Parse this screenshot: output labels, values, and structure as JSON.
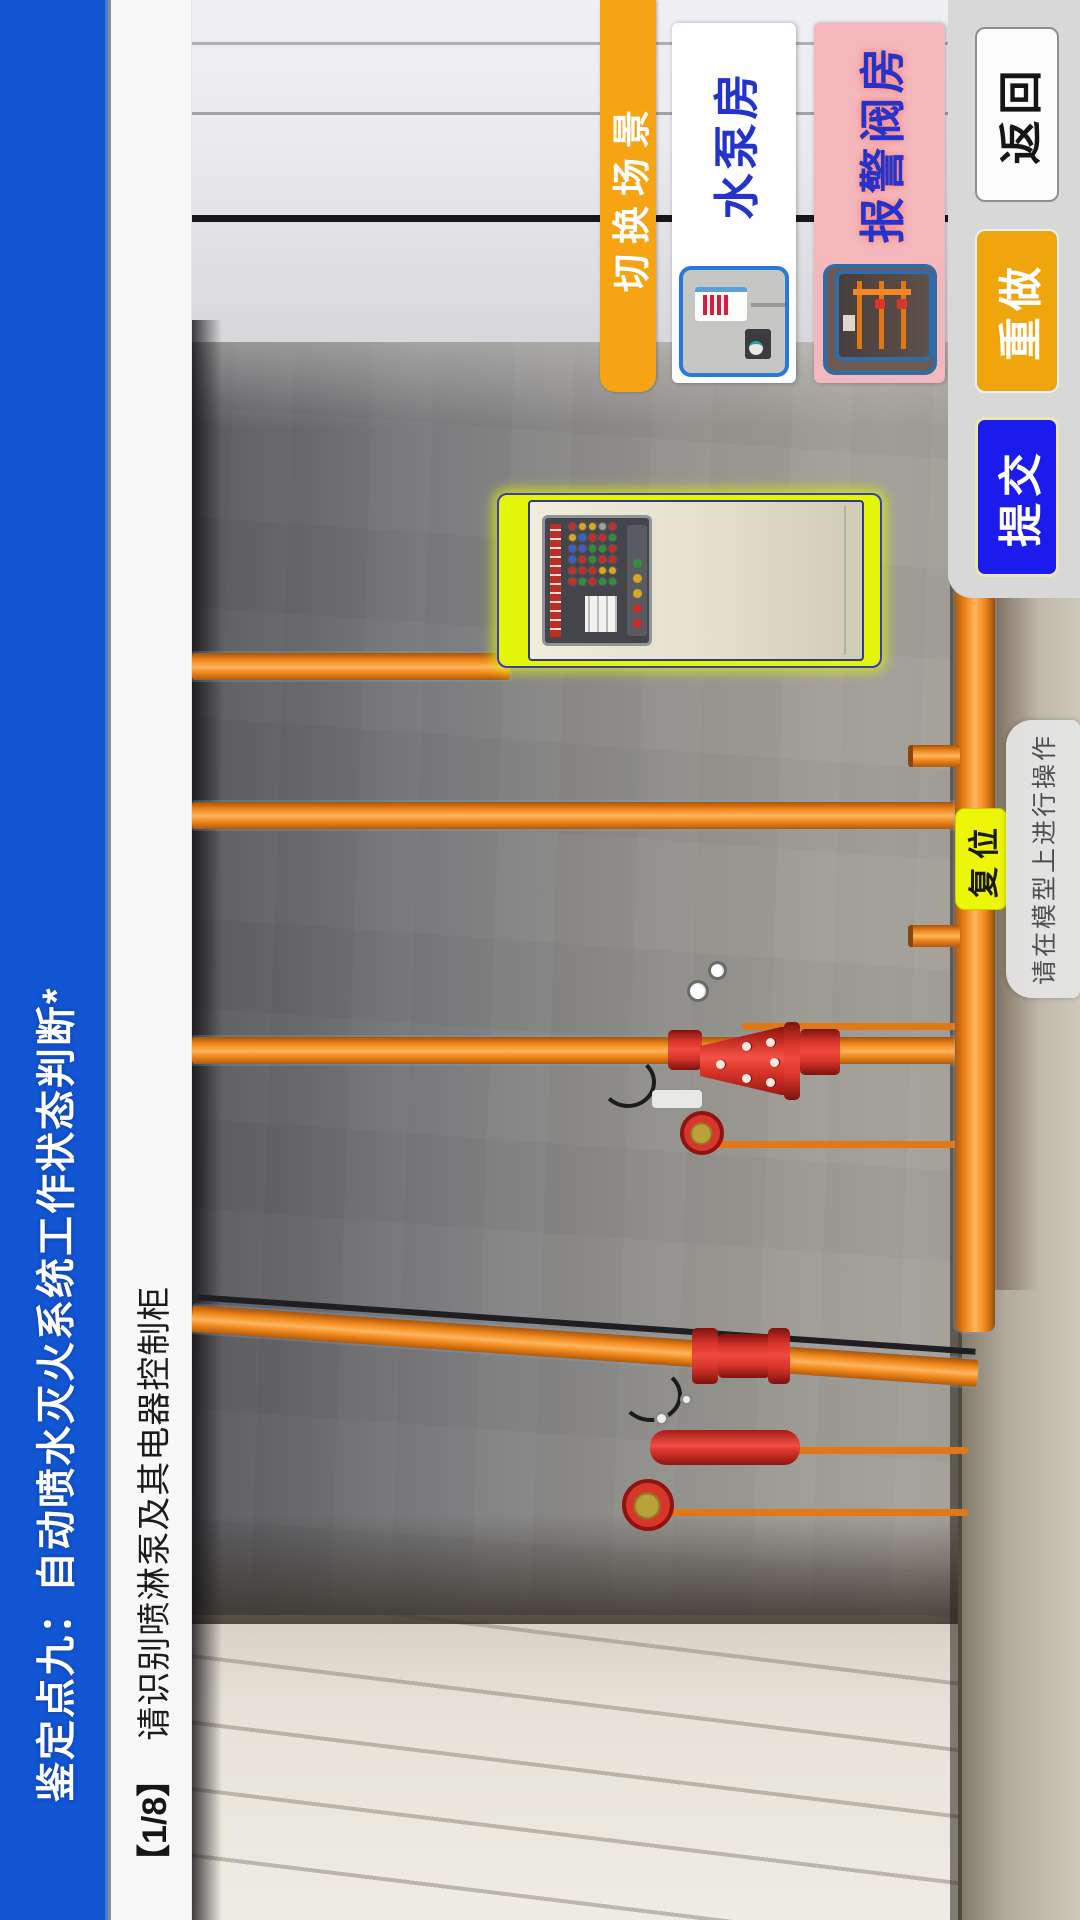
{
  "header": {
    "title": "鉴定点九：自动喷水灭火系统工作状态判断*",
    "bar_color": "#1256d3"
  },
  "task": {
    "progress": "【1/8】",
    "instruction": "请识别喷淋泵及其电器控制柜"
  },
  "scene_switch": {
    "label": "切换场景",
    "tab_color": "#f6a414",
    "options": [
      {
        "label": "水泵房",
        "label_color": "#2433cc",
        "card_color": "#fefefe"
      },
      {
        "label": "报警阀房",
        "label_color": "#2433cc",
        "card_color": "#f4b8bc"
      }
    ]
  },
  "actions": {
    "submit": "提交",
    "redo": "重做",
    "back": "返回"
  },
  "model": {
    "reset": "复位",
    "hint": "请在模型上进行操作"
  },
  "colors": {
    "submit_blue": "#1b1bee",
    "redo_orange": "#f0a50c",
    "reset_yellow": "#edf606",
    "pipe_orange": "#ee8519",
    "valve_red": "#d8352b",
    "cabinet_highlight": "#e4f607",
    "panel_gray": "#d8d8d8"
  },
  "cabinet": {
    "grid_lights": [
      "#cc2a22",
      "#cc2a22",
      "#3a5fd0",
      "#3a5fd0",
      "#d8a81c",
      "#cc2a22",
      "#2f8f3a",
      "#cc2a22",
      "#cc2a22",
      "#3a5fd0",
      "#3a5fd0",
      "#d8a81c",
      "#cc2a22",
      "#cc2a22",
      "#2f8f3a",
      "#2f8f3a",
      "#cc2a22",
      "#d8a81c",
      "#2f8f3a",
      "#d8a81c",
      "#cc2a22",
      "#2f8f3a",
      "#cc2a22",
      "#9aa0a8",
      "#2f8f3a",
      "#d8a81c",
      "#cc2a22",
      "#cc2a22",
      "#2f8f3a",
      "#cc2a22"
    ],
    "strip_lights": [
      "#cc2a22",
      "#cc2a22",
      "#d8a81c",
      "#d8a81c",
      "#2f8f3a"
    ]
  }
}
